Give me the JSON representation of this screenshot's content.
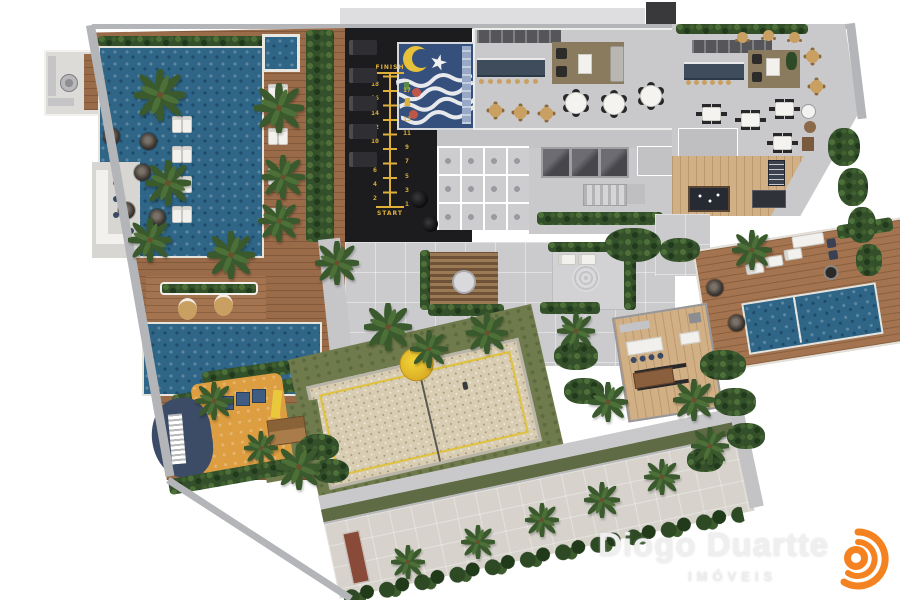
{
  "watermark": {
    "brand": "Diogo Duartte",
    "subtitle": "IMÓVEIS"
  },
  "running_track": {
    "finish_label": "FINISH",
    "start_label": "START",
    "left_numbers": [
      "18",
      "16",
      "14",
      "12",
      "10",
      "8",
      "6",
      "4",
      "2"
    ],
    "right_numbers": [
      "17",
      "15",
      "13",
      "11",
      "9",
      "7",
      "5",
      "3",
      "1"
    ]
  },
  "palette": {
    "water_blue": "#2f6587",
    "wood_deck": "#9a6b49",
    "wood_light": "#d2b086",
    "gym_floor": "#1c1c1f",
    "track_yellow": "#dfaf3a",
    "playroom_navy": "#35507c",
    "hedge_green": "#33502a",
    "lawn_green": "#6f7b4c",
    "sand_beige": "#d8cdb2",
    "court_line_yellow": "#e0c23c",
    "playground_orange": "#dd9e41",
    "playground_blue": "#3c4c66",
    "floor_gray": "#cbcbce",
    "logo_orange": "#f58220",
    "background": "#ffffff"
  },
  "icons": {
    "palm": "palm-tree-icon",
    "umbrella": "parasol-icon",
    "logo": "orange-arcs-logo-icon"
  }
}
